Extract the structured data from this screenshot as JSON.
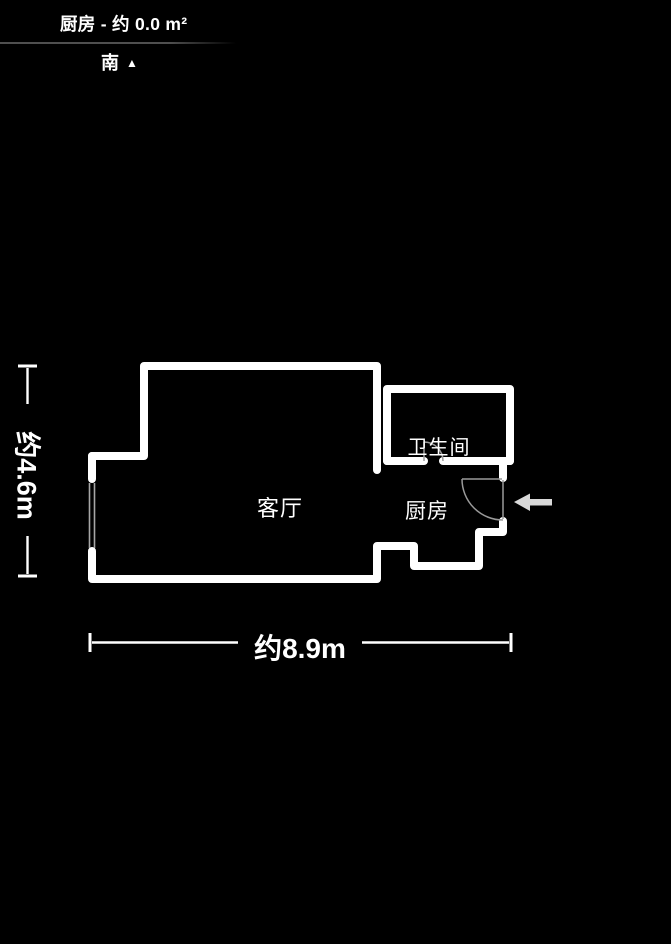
{
  "header": {
    "selected_room_label": "厨房 - 约 0.0 m²",
    "compass": {
      "direction_label": "南",
      "arrow_icon": "▲"
    }
  },
  "floor_plan": {
    "rooms": [
      {
        "name": "客厅"
      },
      {
        "name": "卫生间"
      },
      {
        "name": "厨房"
      }
    ],
    "dimensions": {
      "width_label": "约8.9m",
      "height_label": "约4.6m"
    },
    "colors": {
      "background": "#000000",
      "wall": "#ffffff",
      "thin_line": "#9a9a9a",
      "window_line": "#a6a6a6",
      "entrance_arrow": "#d9d9d9",
      "header_divider": "#4f4f4f",
      "text": "#ffffff"
    }
  }
}
